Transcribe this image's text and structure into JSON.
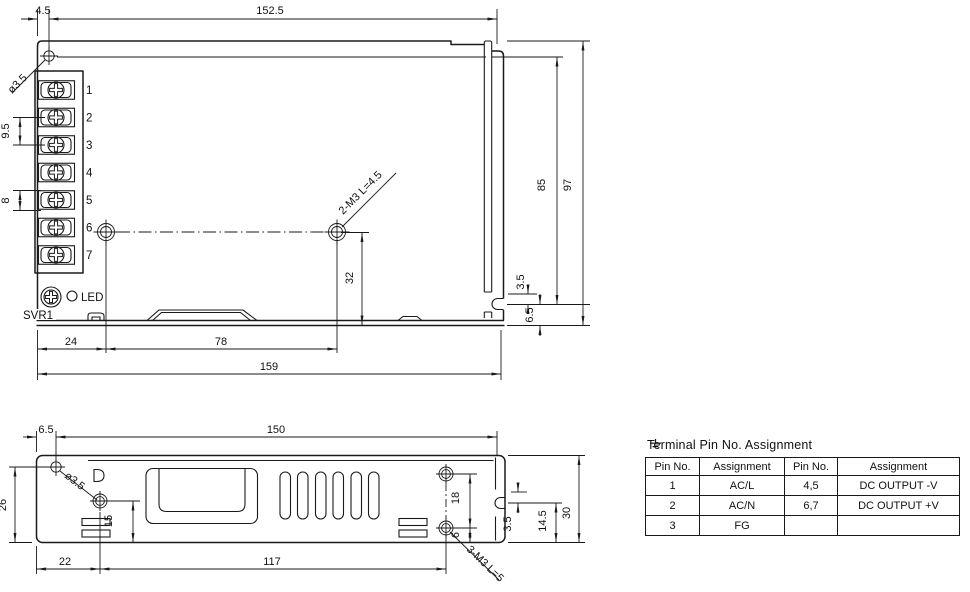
{
  "top_view": {
    "terminal_numbers": [
      "1",
      "2",
      "3",
      "4",
      "5",
      "6",
      "7"
    ],
    "svr_label": "SVR1",
    "led_label": "LED",
    "hole_diameter_label": "ø3.5",
    "screw_callout": "2-M3 L=4.5",
    "dims": {
      "hole_offset_x": "4.5",
      "mount_hole_span": "152.5",
      "terminal_pitch_large": "9.5",
      "terminal_pitch_small": "8",
      "screw_hole_y": "32",
      "body_height": "85",
      "overall_height": "97",
      "side_notch": "3.5",
      "side_hole_edge": "6.5",
      "hole_left_offset": "24",
      "hole_spacing": "78",
      "overall_width": "159"
    }
  },
  "side_view": {
    "hole_diameter_label": "ø3.5",
    "screw_callout": "3-M3 L=5",
    "dims": {
      "hole_offset_x": "6.5",
      "mount_hole_span": "150",
      "hole_height": "26",
      "screw_hole_y": "15",
      "screw_left_offset": "22",
      "screw_spacing": "117",
      "screw_gap": "18",
      "screw_edge": "6",
      "slot_offset": "3.5",
      "slot_edge": "14.5",
      "overall_height": "30"
    }
  },
  "pin_table": {
    "title": "Terminal Pin No. Assignment",
    "headers": [
      "Pin No.",
      "Assignment",
      "Pin No.",
      "Assignment"
    ],
    "rows": [
      [
        "1",
        "AC/L",
        "4,5",
        "DC OUTPUT -V"
      ],
      [
        "2",
        "AC/N",
        "6,7",
        "DC OUTPUT +V"
      ],
      [
        "3",
        "FG",
        "",
        ""
      ]
    ]
  },
  "colors": {
    "line": "#1a1a1a",
    "background": "#ffffff"
  }
}
